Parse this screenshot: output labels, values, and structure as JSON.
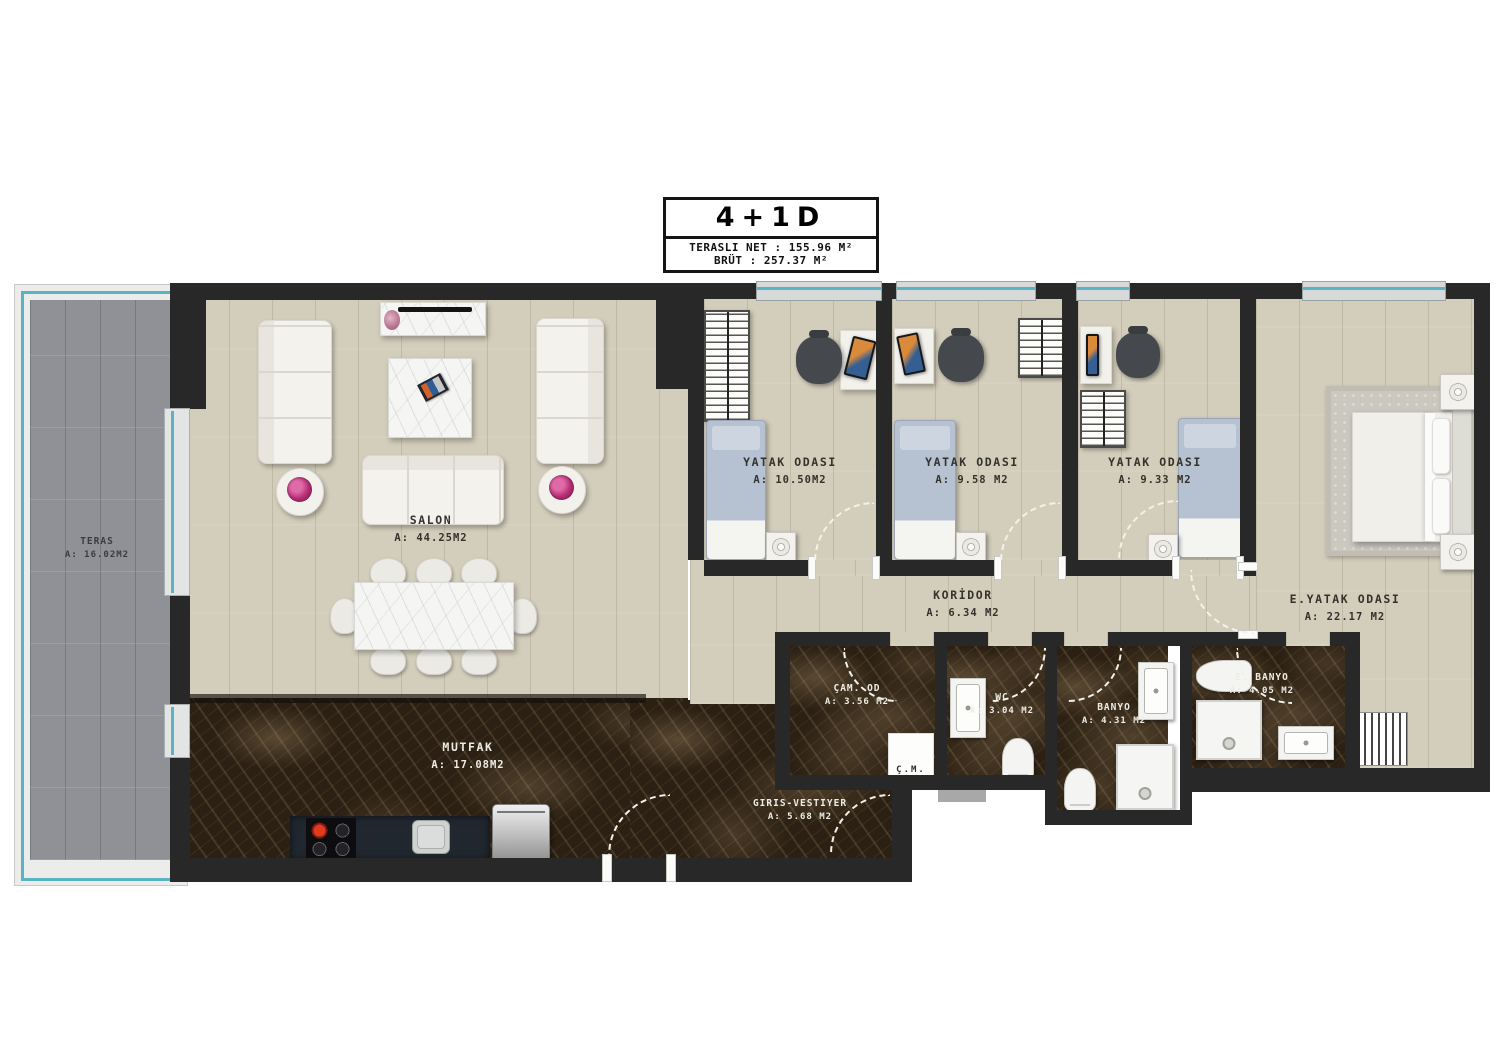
{
  "title_block": {
    "type_label": "4+1D",
    "line1": "TERASLI NET : 155.96 M²",
    "line2": "BRÜT : 257.37 M²"
  },
  "rooms": {
    "teras": {
      "name": "TERAS",
      "area": "A: 16.02M2"
    },
    "salon": {
      "name": "SALON",
      "area": "A: 44.25M2"
    },
    "mutfak": {
      "name": "MUTFAK",
      "area": "A: 17.08M2"
    },
    "giris": {
      "name": "GIRIS-VESTIYER",
      "area": "A: 5.68 M2"
    },
    "yatak1": {
      "name": "YATAK ODASI",
      "area": "A: 10.50M2"
    },
    "yatak2": {
      "name": "YATAK ODASI",
      "area": "A: 9.58 M2"
    },
    "yatak3": {
      "name": "YATAK ODASI",
      "area": "A: 9.33 M2"
    },
    "eyatak": {
      "name": "E.YATAK ODASI",
      "area": "A: 22.17 M2"
    },
    "koridor": {
      "name": "KORİDOR",
      "area": "A: 6.34 M2"
    },
    "camod": {
      "name": "ÇAM. OD",
      "area": "A: 3.56 M2"
    },
    "wc": {
      "name": "WC",
      "area": "A: 3.04 M2"
    },
    "banyo": {
      "name": "BANYO",
      "area": "A: 4.31 M2"
    },
    "ebanyo": {
      "name": "E. BANYO",
      "area": "A: 4.05 M2"
    },
    "cm": {
      "name": "Ç.M."
    }
  },
  "colors": {
    "wall": "#282828",
    "wood": "#d3cdbb",
    "dark_marble": "#2b2013",
    "teras_tile": "#8f9196",
    "window_teal": "#58b4c4",
    "furniture_white": "#f2f1ec",
    "bed_blue": "#b6c1d1",
    "flower_pink": "#b52e72"
  }
}
